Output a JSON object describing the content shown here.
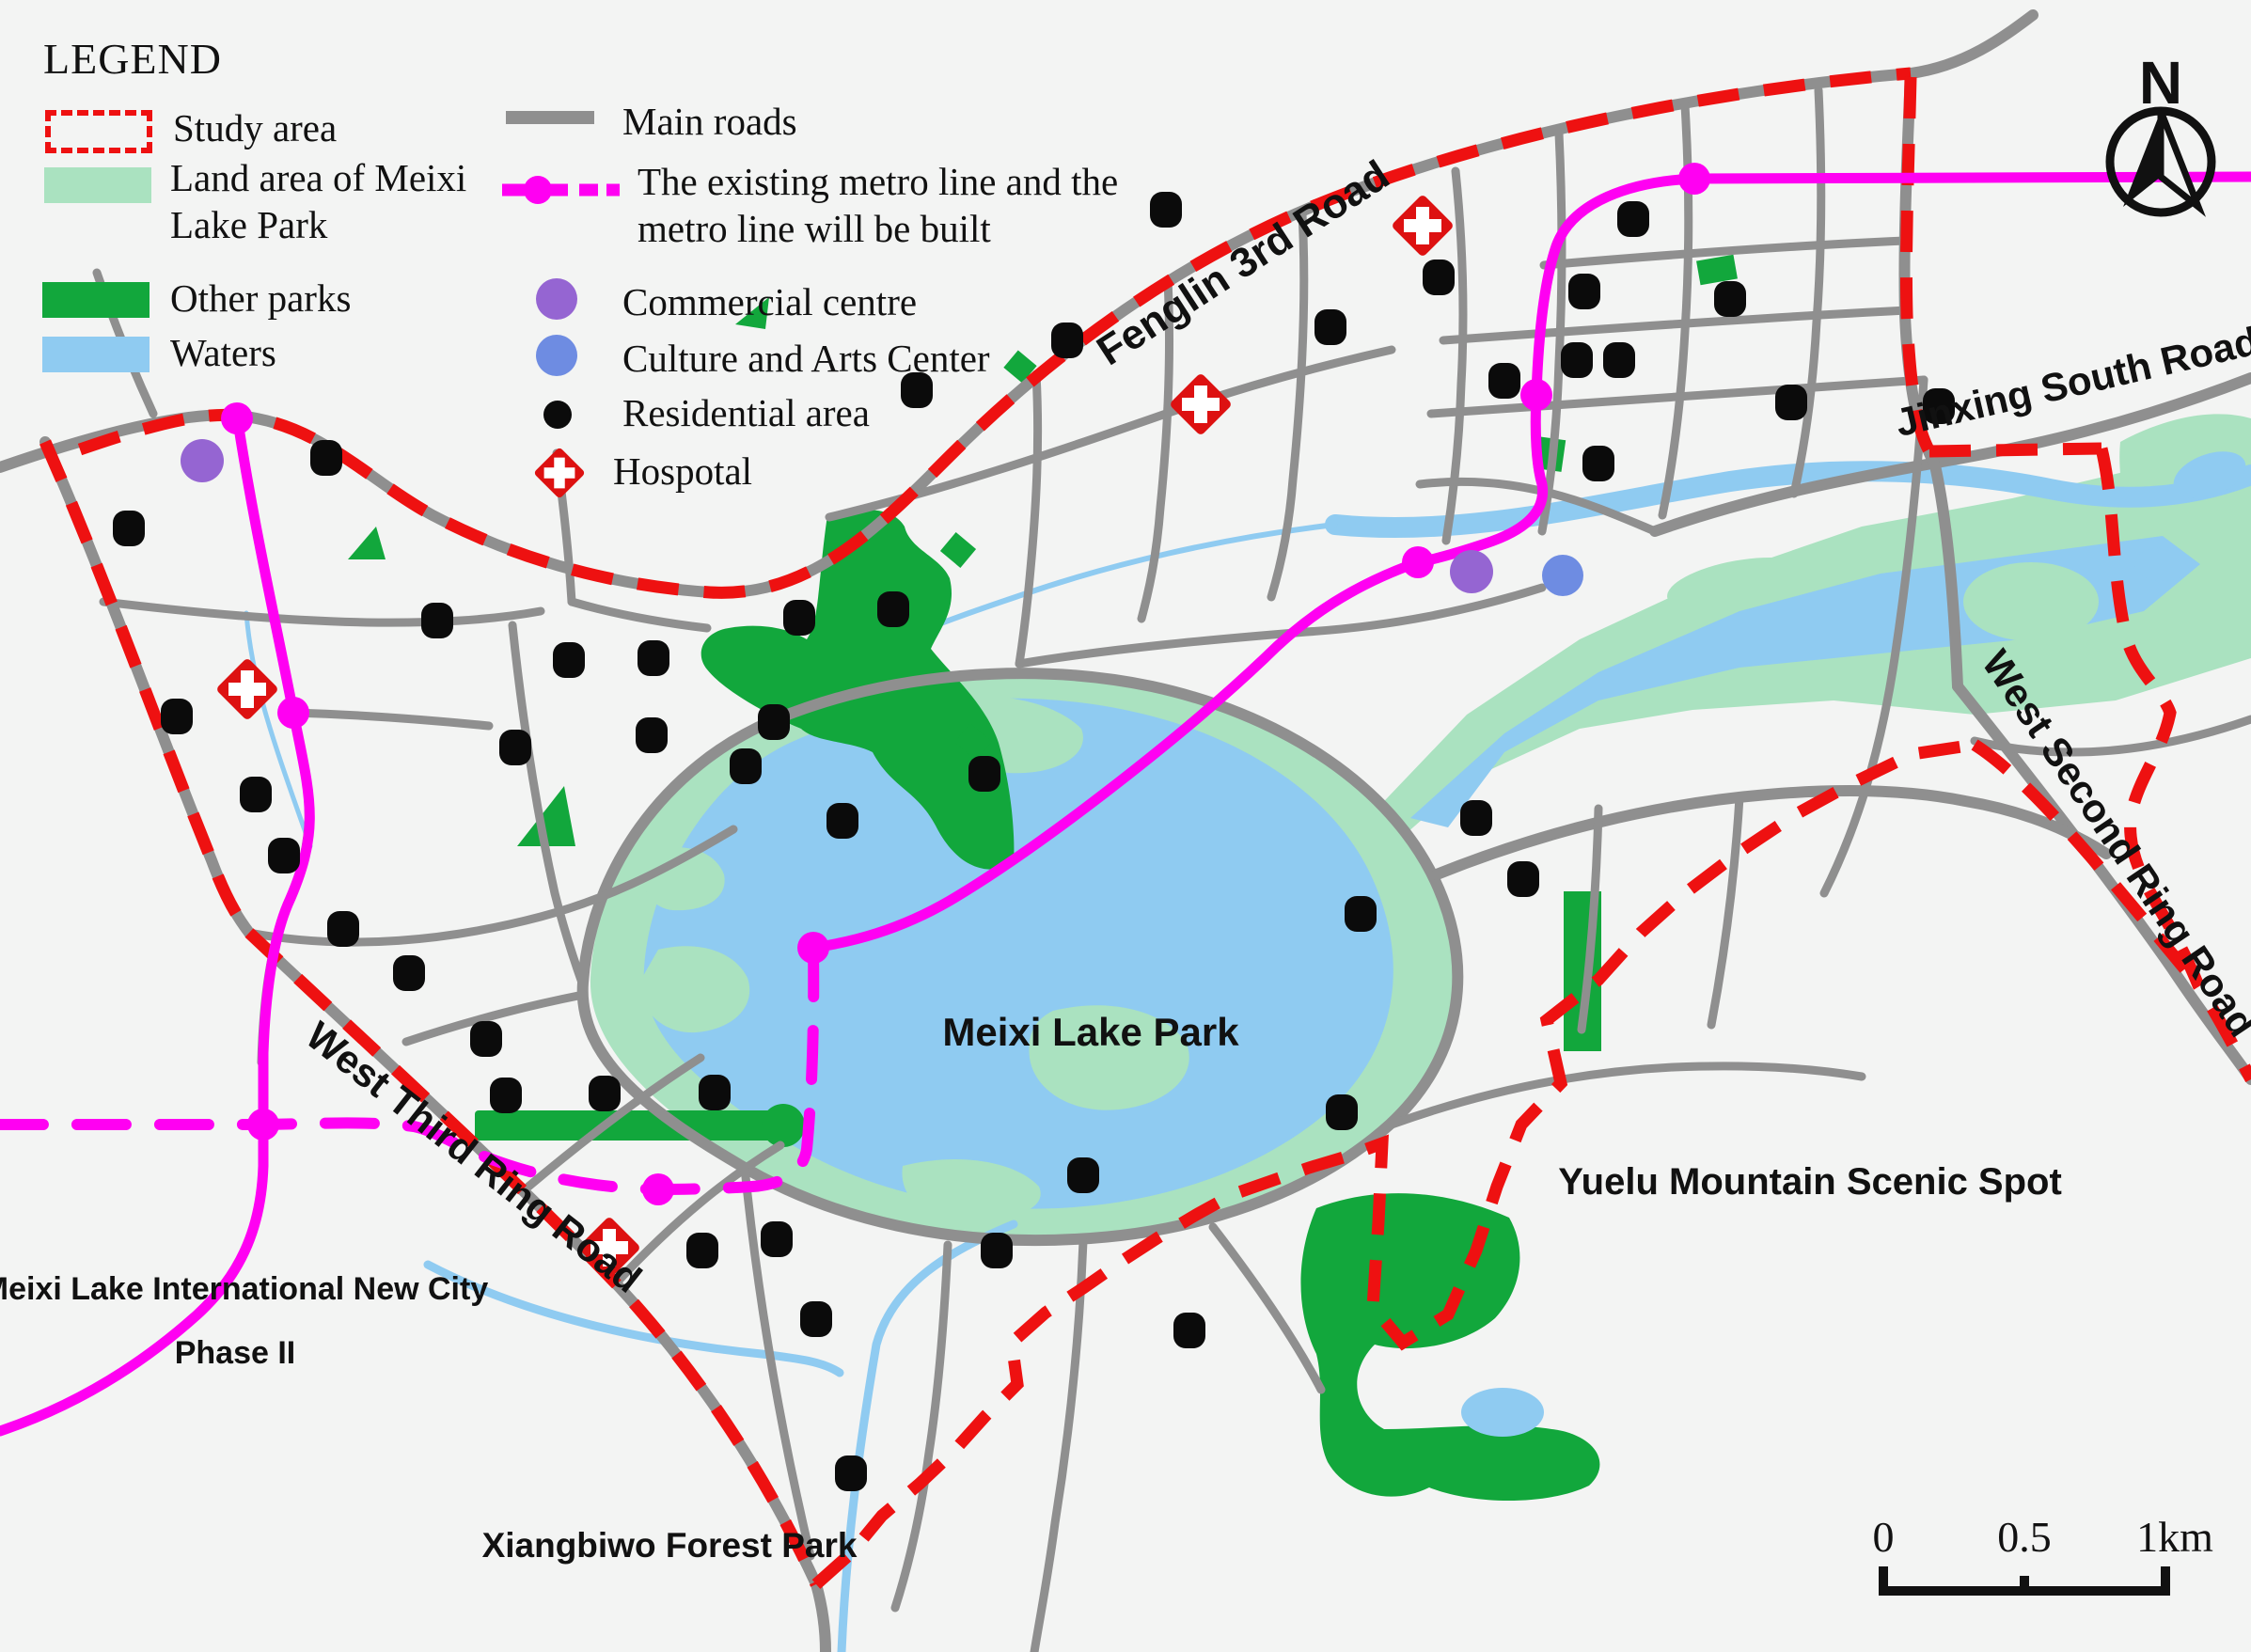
{
  "colors": {
    "background": "#f3f4f3",
    "road_gray": "#8f8f8f",
    "study_area_red": "#ee1111",
    "metro_magenta": "#ff00f2",
    "meixi_park_land_green": "#aae2c0",
    "other_parks_green": "#12a73c",
    "waters_blue": "#8fcbf1",
    "commercial_purple": "#9565d2",
    "culture_blue": "#6e8ce2",
    "residential_black": "#0b0b0b"
  },
  "legend": {
    "title": "LEGEND",
    "left": [
      {
        "label": "Study area"
      },
      {
        "label": "Land area of Meixi Lake Park"
      },
      {
        "label": "Other parks"
      },
      {
        "label": "Waters"
      }
    ],
    "right": [
      {
        "label": "Main roads"
      },
      {
        "label": "The existing metro line and the metro line will be built"
      },
      {
        "label": "Commercial centre"
      },
      {
        "label": "Culture and Arts Center"
      },
      {
        "label": "Residential area"
      },
      {
        "label": "Hospotal"
      }
    ]
  },
  "map_labels": {
    "fenglin_road": "Fenglin 3rd Road",
    "jinxing_road": "Jinxing South Road",
    "west_second_ring_road": "West Second Ring Road",
    "west_third_ring_road": "West Third Ring Road",
    "meixi_lake_park": "Meixi Lake Park",
    "yuelu_mountain": "Yuelu Mountain Scenic Spot",
    "new_city_line1": "Meixi Lake International New City",
    "new_city_line2": "Phase II",
    "xiangbiwo": "Xiangbiwo Forest Park"
  },
  "compass": {
    "label": "N"
  },
  "scale_bar": {
    "ticks": [
      "0",
      "0.5",
      "1km"
    ]
  }
}
